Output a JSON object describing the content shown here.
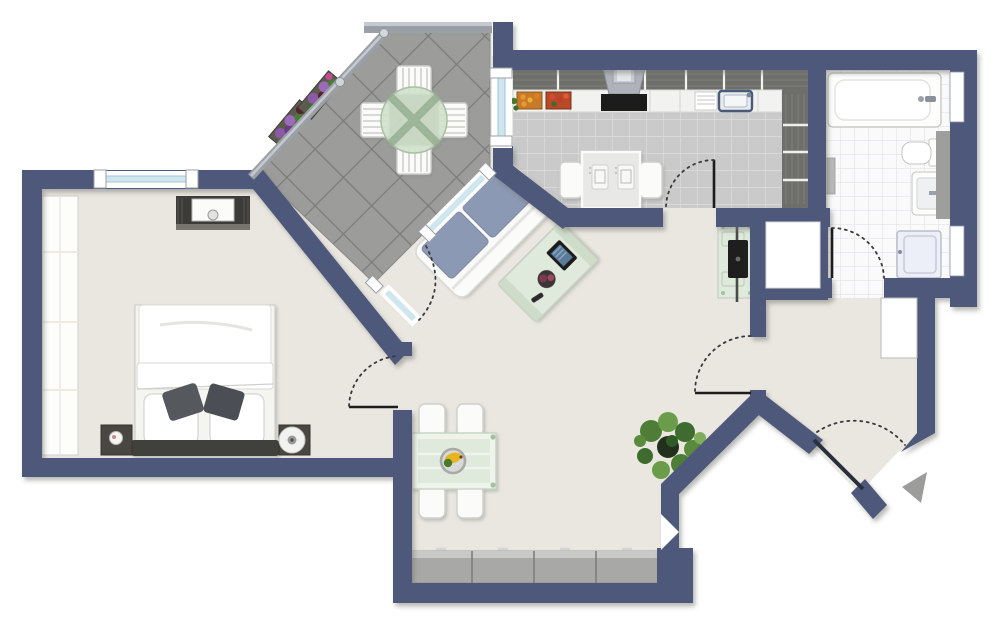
{
  "plan": {
    "type": "apartment-floor-plan",
    "rooms": [
      "bedroom",
      "terrace",
      "kitchen",
      "bathroom",
      "living-room",
      "entry-hall"
    ]
  },
  "colors": {
    "background": "#ffffff",
    "wall": "#4e587a",
    "floor": "#e9e7e0",
    "terrace_tile": "#9c9c9a",
    "terrace_tile_line": "#7b7b79",
    "kitchen_tile": "#c9cac9",
    "kitchen_tile_line": "#dcdddc",
    "bath_tile": "#fafafa",
    "bath_tile_line": "#e1e4e7",
    "glass": "#cfe6ef",
    "table_glass": "#dfe9dc",
    "sofa_cushion": "#8c99b5",
    "sideboard": "#a8a8a6",
    "wood_cabinet": "#6e6e6a",
    "counter": "#f2f2f0",
    "door_leaf": "#1c1c1c",
    "entry_arrow": "#9c9c9a",
    "railing": "#9aa0a6",
    "flower_purple": "#8a5aa8",
    "banana": "#e8b520",
    "plant_green": "#5a8a3c"
  }
}
